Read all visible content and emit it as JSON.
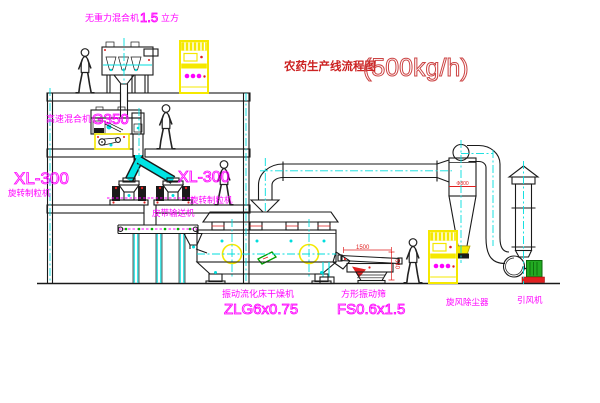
{
  "title": {
    "main": "农药生产线流程图",
    "capacity": "(500kg/h)"
  },
  "equipment": {
    "gravity_mixer": {
      "name": "无重力混合机",
      "capacity": "1.5",
      "unit": "立方"
    },
    "high_speed_mixer": {
      "name": "高速混合机",
      "model": "G350"
    },
    "granulator_left": {
      "model": "XL-300",
      "name": "旋转制粒机"
    },
    "granulator_center": {
      "model": "XL-300",
      "name": "旋转制粒机"
    },
    "belt_conveyor": {
      "name": "皮带输送机"
    },
    "fluid_bed_dryer": {
      "name": "振动流化床干燥机",
      "model": "ZLG6x0.75"
    },
    "vibrating_screen": {
      "name": "方形振动筛",
      "model": "FS0.6x1.5"
    },
    "cyclone": {
      "name": "旋风除尘器",
      "diameter": "Φ800"
    },
    "fan": {
      "name": "引风机"
    }
  },
  "dimensions": {
    "screen_length": "1500",
    "screen_height": "540"
  },
  "colors": {
    "magenta": "#ff00ff",
    "cyan": "#00dddd",
    "yellow": "#f5e800",
    "red": "#e02020",
    "title_red": "#cc2222",
    "green": "#22aa22",
    "line": "#1a1a1a",
    "background": "#ffffff"
  }
}
